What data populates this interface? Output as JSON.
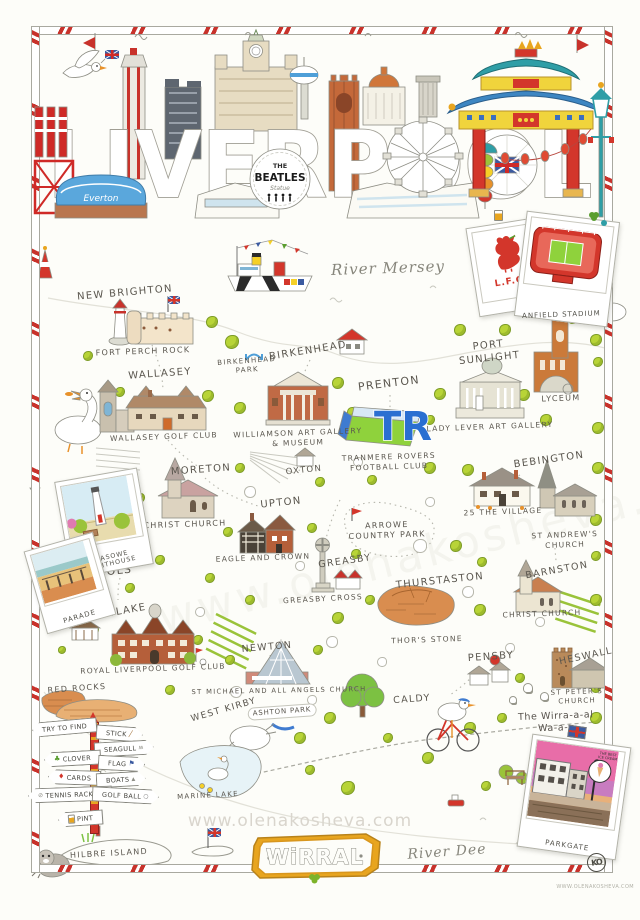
{
  "poster": {
    "title": "LIVERPOOL",
    "banner_text": "WiRRAL",
    "watermark": "www.olenakosheva.com",
    "footer_url": "WWW.OLENAKOSHEVA.COM",
    "monogram": "KO"
  },
  "header": {
    "everton_text": "Everton",
    "beatles": {
      "line1": "THE",
      "line2": "BEATLES",
      "line3": "Statue"
    }
  },
  "polaroids": {
    "lfc": "L.F.C.",
    "anfield": "ANFIELD STADIUM",
    "leasowe": "LEASOWE LIGHTHOUSE",
    "parade": "PARADE",
    "parkgate": "PARKGATE",
    "parkgate_badge": "THE BEST\nICE CREAM"
  },
  "rivers": {
    "mersey": "River Mersey",
    "dee": "River Dee"
  },
  "colors": {
    "accent_red": "#c8322b",
    "foliage_green": "#b8d437",
    "banner_gold": "#e8a51f",
    "tranmere_blue": "#2a6fd1",
    "everton_blue": "#5aa7dc",
    "cathedral_orange": "#c4693a",
    "ink": "#5a564e"
  },
  "map": {
    "tr_logo": "TR",
    "places": [
      {
        "id": "label-new-brighton",
        "t": "NEW BRIGHTON",
        "x": 125,
        "y": 293,
        "fs": 10,
        "r": -5
      },
      {
        "id": "label-fort-perch-rock",
        "t": "FORT PERCH ROCK",
        "x": 143,
        "y": 352,
        "fs": 8,
        "r": -2
      },
      {
        "id": "label-wallasey",
        "t": "WALLASEY",
        "x": 160,
        "y": 374,
        "fs": 10,
        "r": -4
      },
      {
        "id": "label-wallasey-golf-club",
        "t": "WALLASEY GOLF CLUB",
        "x": 164,
        "y": 437,
        "fs": 7.5,
        "r": -2
      },
      {
        "id": "label-birkenhead",
        "t": "BIRKENHEAD",
        "x": 308,
        "y": 351,
        "fs": 10,
        "r": -9
      },
      {
        "id": "label-birkenhead-park",
        "t": "BIRKENHEAD\nPARK",
        "x": 247,
        "y": 366,
        "fs": 7,
        "r": -4
      },
      {
        "id": "label-williamson",
        "t": "WILLIAMSON ART GALLERY\n& MUSEUM",
        "x": 298,
        "y": 438,
        "fs": 7.5,
        "r": -2
      },
      {
        "id": "label-prenton",
        "t": "PRENTON",
        "x": 389,
        "y": 384,
        "fs": 11,
        "r": -7
      },
      {
        "id": "label-tranmere",
        "t": "TRANMERE ROVERS\nFOOTBALL CLUB",
        "x": 389,
        "y": 462,
        "fs": 7.5,
        "r": -2
      },
      {
        "id": "label-port-sunlight",
        "t": "PORT\nSUNLIGHT",
        "x": 489,
        "y": 352,
        "fs": 10,
        "r": -6
      },
      {
        "id": "label-lady-lever",
        "t": "LADY LEVER ART GALLERY",
        "x": 490,
        "y": 427,
        "fs": 7.5,
        "r": -2
      },
      {
        "id": "label-lyceum",
        "t": "LYCEUM",
        "x": 561,
        "y": 399,
        "fs": 8,
        "r": -2
      },
      {
        "id": "label-oxton",
        "t": "OXTON",
        "x": 304,
        "y": 471,
        "fs": 8.5,
        "r": -6
      },
      {
        "id": "label-moreton",
        "t": "MORETON",
        "x": 201,
        "y": 470,
        "fs": 10,
        "r": -4
      },
      {
        "id": "label-christ-church-moreton",
        "t": "CHRIST CHURCH",
        "x": 185,
        "y": 525,
        "fs": 8,
        "r": -2
      },
      {
        "id": "label-upton",
        "t": "UPTON",
        "x": 281,
        "y": 503,
        "fs": 10,
        "r": -6
      },
      {
        "id": "label-eagle-and-crown",
        "t": "EAGLE AND CROWN",
        "x": 263,
        "y": 558,
        "fs": 7.5,
        "r": -2
      },
      {
        "id": "label-arrowe-country-park",
        "t": "ARROWE\nCOUNTRY PARK",
        "x": 387,
        "y": 531,
        "fs": 8,
        "r": -2
      },
      {
        "id": "label-greasby",
        "t": "GREASBY",
        "x": 345,
        "y": 562,
        "fs": 9.5,
        "r": -8
      },
      {
        "id": "label-greasby-cross",
        "t": "GREASBY CROSS",
        "x": 323,
        "y": 599,
        "fs": 7.5,
        "r": -3
      },
      {
        "id": "label-bebington",
        "t": "BEBINGTON",
        "x": 549,
        "y": 460,
        "fs": 10,
        "r": -8
      },
      {
        "id": "label-25-the-village",
        "t": "25 THE VILLAGE",
        "x": 503,
        "y": 512,
        "fs": 7.5,
        "r": -2
      },
      {
        "id": "label-st-andrews-church",
        "t": "ST ANDREW'S CHURCH",
        "x": 565,
        "y": 540,
        "fs": 7.5,
        "r": -2
      },
      {
        "id": "label-thurstaston",
        "t": "THURSTASTON",
        "x": 440,
        "y": 581,
        "fs": 10,
        "r": -6
      },
      {
        "id": "label-thors-stone",
        "t": "THOR'S STONE",
        "x": 427,
        "y": 640,
        "fs": 7.5,
        "r": -2
      },
      {
        "id": "label-barnston",
        "t": "BARNSTON",
        "x": 557,
        "y": 571,
        "fs": 9.5,
        "r": -10
      },
      {
        "id": "label-christ-church-barnston",
        "t": "CHRIST CHURCH",
        "x": 542,
        "y": 614,
        "fs": 7.5,
        "r": -2
      },
      {
        "id": "label-meols",
        "t": "MEOLS",
        "x": 110,
        "y": 572,
        "fs": 11,
        "r": -6
      },
      {
        "id": "label-hoylake",
        "t": "HOYLAKE",
        "x": 119,
        "y": 612,
        "fs": 10,
        "r": -10
      },
      {
        "id": "label-royal-liverpool-golf-club",
        "t": "ROYAL LIVERPOOL GOLF CLUB",
        "x": 153,
        "y": 669,
        "fs": 7.5,
        "r": -2
      },
      {
        "id": "label-red-rocks",
        "t": "RED ROCKS",
        "x": 77,
        "y": 689,
        "fs": 8,
        "r": -4
      },
      {
        "id": "label-newton",
        "t": "NEWTON",
        "x": 267,
        "y": 648,
        "fs": 9.5,
        "r": -5
      },
      {
        "id": "label-st-michael",
        "t": "ST MICHAEL AND ALL ANGELS CHURCH",
        "x": 279,
        "y": 691,
        "fs": 6.8,
        "r": -1
      },
      {
        "id": "label-west-kirby",
        "t": "WEST KIRBY",
        "x": 224,
        "y": 711,
        "fs": 9,
        "r": -16
      },
      {
        "id": "label-ashton-park",
        "t": "ASHTON PARK",
        "x": 282,
        "y": 712,
        "fs": 7,
        "r": -4,
        "c": "sign"
      },
      {
        "id": "label-marine-lake",
        "t": "MARINE LAKE",
        "x": 208,
        "y": 796,
        "fs": 7,
        "r": -3
      },
      {
        "id": "label-caldy",
        "t": "CALDY",
        "x": 412,
        "y": 700,
        "fs": 9.5,
        "r": -4
      },
      {
        "id": "label-pensby",
        "t": "PENSBY",
        "x": 491,
        "y": 657,
        "fs": 10,
        "r": -4
      },
      {
        "id": "label-heswall",
        "t": "HESWALL",
        "x": 586,
        "y": 657,
        "fs": 9.5,
        "r": -12
      },
      {
        "id": "label-st-peters-church",
        "t": "ST PETER'S CHURCH",
        "x": 577,
        "y": 697,
        "fs": 7,
        "r": -2
      },
      {
        "id": "label-hilbre-island",
        "t": "HILBRE ISLAND",
        "x": 109,
        "y": 854,
        "fs": 8,
        "r": -3
      },
      {
        "id": "label-wirral-way",
        "t": "The Wirra-a-al Wa-a-y",
        "x": 556,
        "y": 723,
        "fs": 9.5,
        "r": -2,
        "c": "script2"
      }
    ],
    "flora": [
      [
        212,
        322,
        12,
        "t"
      ],
      [
        232,
        342,
        14,
        "t"
      ],
      [
        88,
        356,
        10,
        "t"
      ],
      [
        120,
        392,
        10,
        "t"
      ],
      [
        208,
        396,
        12,
        "t"
      ],
      [
        240,
        408,
        12,
        "t"
      ],
      [
        338,
        383,
        12,
        "t"
      ],
      [
        352,
        412,
        10,
        "t"
      ],
      [
        440,
        394,
        12,
        "t"
      ],
      [
        430,
        420,
        10,
        "t"
      ],
      [
        460,
        330,
        12,
        "t"
      ],
      [
        505,
        330,
        12,
        "t"
      ],
      [
        573,
        318,
        12,
        "t"
      ],
      [
        596,
        340,
        12,
        "t"
      ],
      [
        598,
        362,
        10,
        "t"
      ],
      [
        524,
        395,
        12,
        "t"
      ],
      [
        546,
        420,
        12,
        "t"
      ],
      [
        598,
        428,
        12,
        "t"
      ],
      [
        240,
        468,
        10,
        "t"
      ],
      [
        320,
        482,
        10,
        "t"
      ],
      [
        372,
        480,
        10,
        "t"
      ],
      [
        430,
        468,
        12,
        "t"
      ],
      [
        468,
        470,
        12,
        "t"
      ],
      [
        598,
        468,
        12,
        "t"
      ],
      [
        140,
        498,
        10,
        "t"
      ],
      [
        228,
        532,
        10,
        "t"
      ],
      [
        312,
        528,
        10,
        "t"
      ],
      [
        356,
        554,
        10,
        "t"
      ],
      [
        456,
        546,
        12,
        "t"
      ],
      [
        482,
        562,
        10,
        "t"
      ],
      [
        596,
        520,
        12,
        "t"
      ],
      [
        596,
        556,
        10,
        "t"
      ],
      [
        160,
        560,
        10,
        "t"
      ],
      [
        130,
        588,
        10,
        "t"
      ],
      [
        210,
        578,
        10,
        "t"
      ],
      [
        250,
        600,
        10,
        "t"
      ],
      [
        338,
        618,
        12,
        "t"
      ],
      [
        370,
        600,
        10,
        "t"
      ],
      [
        480,
        610,
        12,
        "t"
      ],
      [
        596,
        600,
        12,
        "t"
      ],
      [
        198,
        640,
        10,
        "t"
      ],
      [
        230,
        660,
        10,
        "t"
      ],
      [
        318,
        650,
        10,
        "t"
      ],
      [
        300,
        738,
        12,
        "t"
      ],
      [
        330,
        718,
        12,
        "t"
      ],
      [
        428,
        758,
        12,
        "t"
      ],
      [
        388,
        738,
        10,
        "t"
      ],
      [
        470,
        728,
        12,
        "t"
      ],
      [
        502,
        718,
        10,
        "t"
      ],
      [
        596,
        718,
        12,
        "t"
      ],
      [
        348,
        788,
        14,
        "t"
      ],
      [
        310,
        770,
        10,
        "t"
      ],
      [
        95,
        630,
        8,
        "t"
      ],
      [
        62,
        650,
        8,
        "t"
      ],
      [
        170,
        690,
        10,
        "t"
      ],
      [
        596,
        688,
        10,
        "t"
      ],
      [
        520,
        678,
        10,
        "t"
      ],
      [
        486,
        786,
        10,
        "t"
      ],
      [
        596,
        752,
        10,
        "t"
      ],
      [
        250,
        492,
        12,
        "b"
      ],
      [
        420,
        546,
        14,
        "b"
      ],
      [
        300,
        566,
        10,
        "b"
      ],
      [
        468,
        592,
        12,
        "b"
      ],
      [
        200,
        612,
        10,
        "b"
      ],
      [
        332,
        642,
        12,
        "b"
      ],
      [
        382,
        662,
        10,
        "b"
      ],
      [
        540,
        622,
        10,
        "b"
      ],
      [
        430,
        502,
        10,
        "b"
      ],
      [
        358,
        462,
        10,
        "b"
      ],
      [
        510,
        648,
        10,
        "b"
      ],
      [
        236,
        692,
        12,
        "b"
      ],
      [
        560,
        756,
        12,
        "b"
      ],
      [
        312,
        700,
        10,
        "b"
      ],
      [
        528,
        688,
        10,
        "s"
      ],
      [
        544,
        696,
        9,
        "s"
      ],
      [
        513,
        700,
        8,
        "s"
      ]
    ],
    "signpost": {
      "arrows": [
        {
          "t": "TRY TO FIND",
          "dir": "left",
          "x": 2,
          "y": 6,
          "r": -5,
          "icon": ""
        },
        {
          "t": "STICK",
          "dir": "right",
          "x": 66,
          "y": 12,
          "r": 4,
          "icon": "stick"
        },
        {
          "t": "SEAGULL",
          "dir": "right",
          "x": 64,
          "y": 27,
          "r": -3,
          "icon": "seagull"
        },
        {
          "t": "CLOVER",
          "dir": "left",
          "x": 14,
          "y": 37,
          "r": -3,
          "icon": "clover"
        },
        {
          "t": "FLAG",
          "dir": "right",
          "x": 68,
          "y": 42,
          "r": 3,
          "icon": "flag"
        },
        {
          "t": "CARDS",
          "dir": "left",
          "x": 18,
          "y": 56,
          "r": 2,
          "icon": "cards"
        },
        {
          "t": "BOATS",
          "dir": "right",
          "x": 66,
          "y": 58,
          "r": -3,
          "icon": "boats"
        },
        {
          "t": "TENNIS RACKET",
          "dir": "left",
          "x": -2,
          "y": 73,
          "r": -2,
          "icon": "racket"
        },
        {
          "t": "GOLF BALL",
          "dir": "right",
          "x": 62,
          "y": 74,
          "r": 3,
          "icon": "golf"
        },
        {
          "t": "PINT",
          "dir": "left",
          "x": 28,
          "y": 97,
          "r": -4,
          "icon": "pint"
        }
      ]
    }
  }
}
